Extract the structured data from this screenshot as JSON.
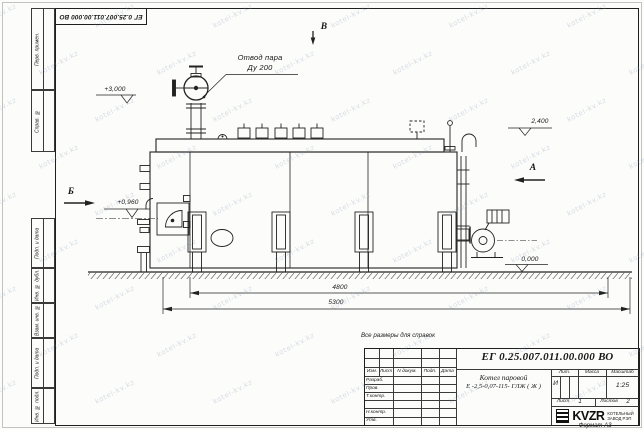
{
  "watermark": {
    "text": "kotel-kv.kz"
  },
  "frame": {
    "stamp_number": "ЕГ 0.25.007.011.00.000  ВО",
    "columns_top": [
      "Перв. примен.",
      "Справ. №"
    ],
    "columns_bottom": [
      "Подп. и дата",
      "Инв. № дубл.",
      "Взам. инв. №",
      "Подп. и дата",
      "Инв. № подл."
    ],
    "format_note": "Формат А3"
  },
  "drawing": {
    "note": "Все размеры для справок",
    "steam_label_line1": "Отвод пара",
    "steam_label_line2": "Ду 200",
    "elevations": {
      "top": "+3,000",
      "drum": "2,400",
      "burner": "+0,960",
      "ground": "0,000"
    },
    "dimensions": {
      "inner": "4800",
      "outer": "5300"
    },
    "sections": {
      "left": "Б",
      "right": "А",
      "top": "В"
    }
  },
  "title_block": {
    "doc_number": "ЕГ 0.25.007.011.00.000  ВО",
    "product_name_line1": "Котел паровой",
    "product_name_line2": "Е -2,5-0,07-115- ГЛЖ ( Ж )",
    "change_header": {
      "izm": "Изм.",
      "list": "Лист",
      "doc": "N докум.",
      "sign": "Подп.",
      "date": "Дата"
    },
    "rows": {
      "developed": "Разраб.",
      "checked": "Пров.",
      "tcontrol": "Т.контр.",
      "ncontrol": "Н.контр.",
      "approved": "Утв."
    },
    "lit_header": "Лит.",
    "mass_header": "Масса",
    "scale_header": "Масштаб",
    "lit_value": "И",
    "scale_value": "1:25",
    "sheet_label": "Лист",
    "sheet_value": "1",
    "sheets_label": "Листов",
    "sheets_value": "2",
    "company": {
      "logo_text": "KVZR",
      "line1": "КОТЕЛЬНЫЙ",
      "line2": "ЗАВОД РЭП"
    }
  }
}
